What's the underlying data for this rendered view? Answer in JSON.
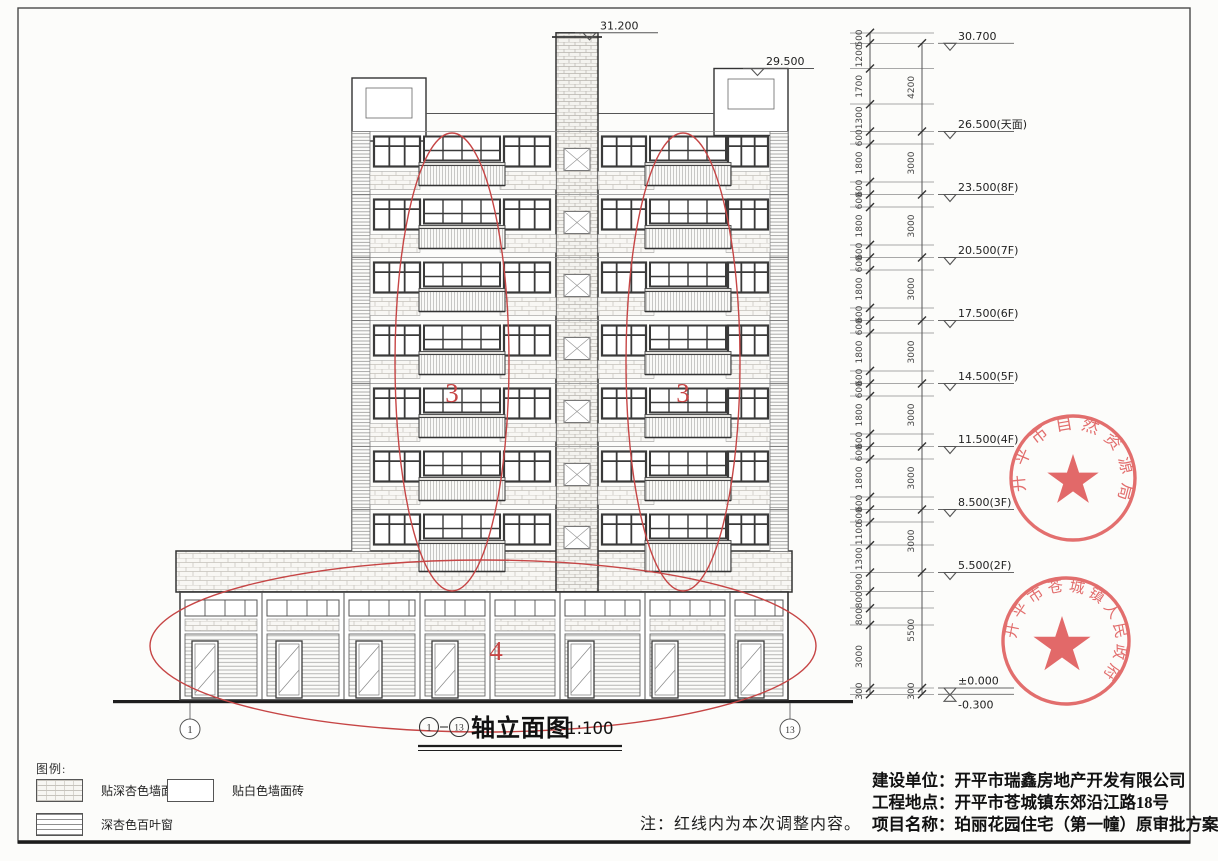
{
  "title": {
    "axis_start": "1",
    "axis_end": "13",
    "name": "轴立面图",
    "scale": "1:100"
  },
  "note": "注：红线内为本次调整内容。",
  "legend": {
    "heading": "图例:",
    "items": [
      {
        "label": "贴深杏色墙面砖",
        "pattern": "brick"
      },
      {
        "label": "贴白色墙面砖",
        "pattern": "plain"
      },
      {
        "label": "深杏色百叶窗",
        "pattern": "louver"
      }
    ]
  },
  "project_info": [
    {
      "label": "建设单位：",
      "value": "开平市瑞鑫房地产开发有限公司"
    },
    {
      "label": "工程地点：",
      "value": "开平市苍城镇东郊沿江路18号"
    },
    {
      "label": "项目名称：",
      "value": "珀丽花园住宅（第一幢）原审批方案"
    }
  ],
  "stamps": [
    {
      "text": "开平市自然资源局",
      "color": "#dd4f4f"
    },
    {
      "text": "开平市苍城镇人民政府",
      "color": "#dd4f4f"
    }
  ],
  "building_markers": [
    {
      "value": "31.200"
    },
    {
      "value": "29.500"
    }
  ],
  "levels": [
    {
      "value": "30.700",
      "suffix": ""
    },
    {
      "value": "26.500",
      "suffix": "(天面)"
    },
    {
      "value": "23.500",
      "suffix": "(8F)"
    },
    {
      "value": "20.500",
      "suffix": "(7F)"
    },
    {
      "value": "17.500",
      "suffix": "(6F)"
    },
    {
      "value": "14.500",
      "suffix": "(5F)"
    },
    {
      "value": "11.500",
      "suffix": "(4F)"
    },
    {
      "value": "8.500",
      "suffix": "(3F)"
    },
    {
      "value": "5.500",
      "suffix": "(2F)"
    },
    {
      "value": "±0.000",
      "suffix": ""
    },
    {
      "value": "-0.300",
      "suffix": ""
    }
  ],
  "dimensions": {
    "inner": [
      "500",
      "1200",
      "1700",
      "1300",
      "600",
      "1800",
      "600",
      "600",
      "1800",
      "600",
      "600",
      "1800",
      "600",
      "600",
      "1800",
      "600",
      "600",
      "1800",
      "600",
      "600",
      "1800",
      "600",
      "600",
      "1100",
      "1300",
      "900",
      "800",
      "800",
      "3000",
      "300"
    ],
    "outer": [
      "4200",
      "3000",
      "3000",
      "3000",
      "3000",
      "3000",
      "3000",
      "3000",
      "5500",
      "300"
    ]
  },
  "red_annotations": {
    "labels": [
      "3",
      "3",
      "4"
    ],
    "color": "#c64545"
  },
  "axis_bubbles": [
    "1",
    "13"
  ]
}
